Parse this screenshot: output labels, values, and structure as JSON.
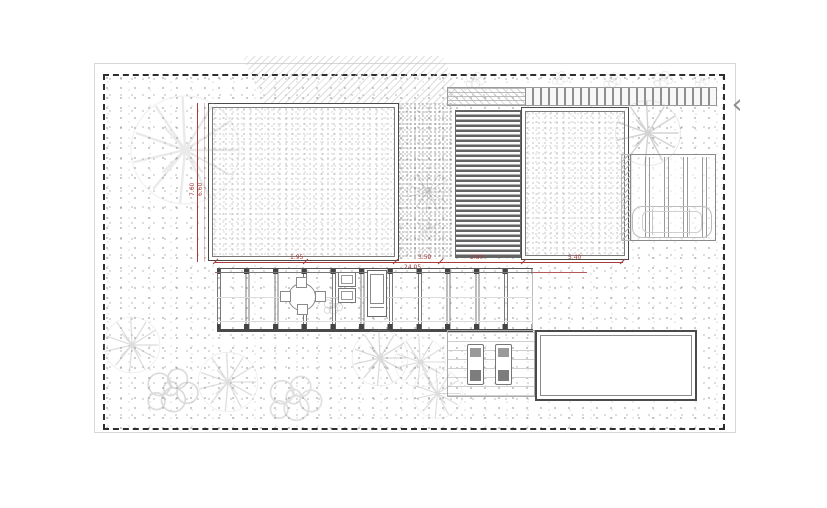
{
  "viewer": {
    "nav_prev_symbol": "‹"
  },
  "colors": {
    "dimension_red": "#a83b3b",
    "drawing_line": "#4a4a4a",
    "boundary": "#2e2e2e",
    "background": "#ffffff"
  },
  "plan": {
    "dimensions": {
      "horizontal": {
        "segments": [
          {
            "value": "1.95"
          },
          {
            "value": "3.50"
          },
          {
            "value": "3.80"
          },
          {
            "value": "5.40"
          }
        ],
        "total": "24.05"
      },
      "vertical": {
        "segments": [
          {
            "value": "7.60"
          },
          {
            "value": "6.60"
          }
        ]
      }
    }
  }
}
